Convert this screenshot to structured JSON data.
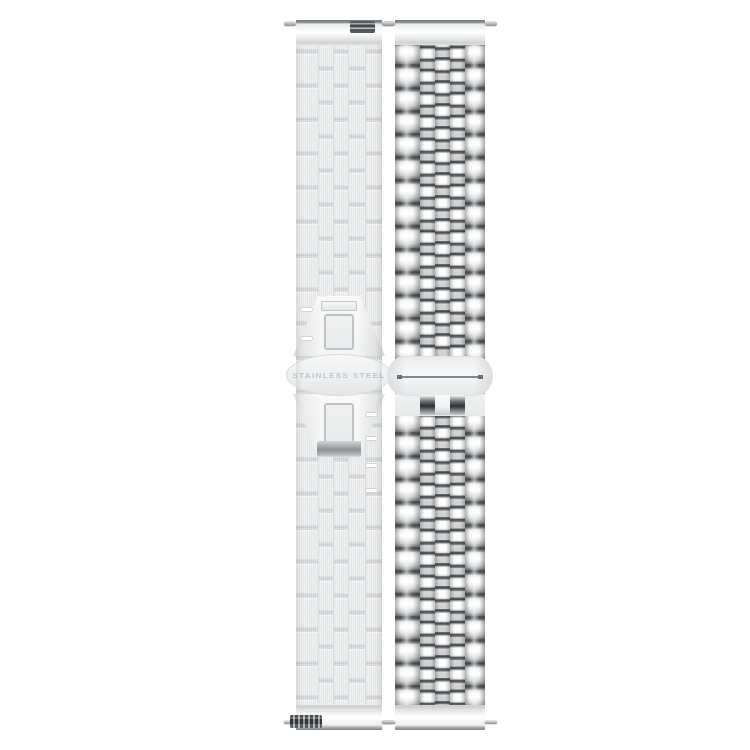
{
  "product": {
    "engraving": "STAINLESS STEEL"
  },
  "colors": {
    "background": "#ffffff",
    "engraving": "#c2c5c7",
    "steel_bright": "#ffffff",
    "steel_light": "#eaecee",
    "steel_mid": "#c8cacc",
    "steel_dark": "#45484a"
  }
}
